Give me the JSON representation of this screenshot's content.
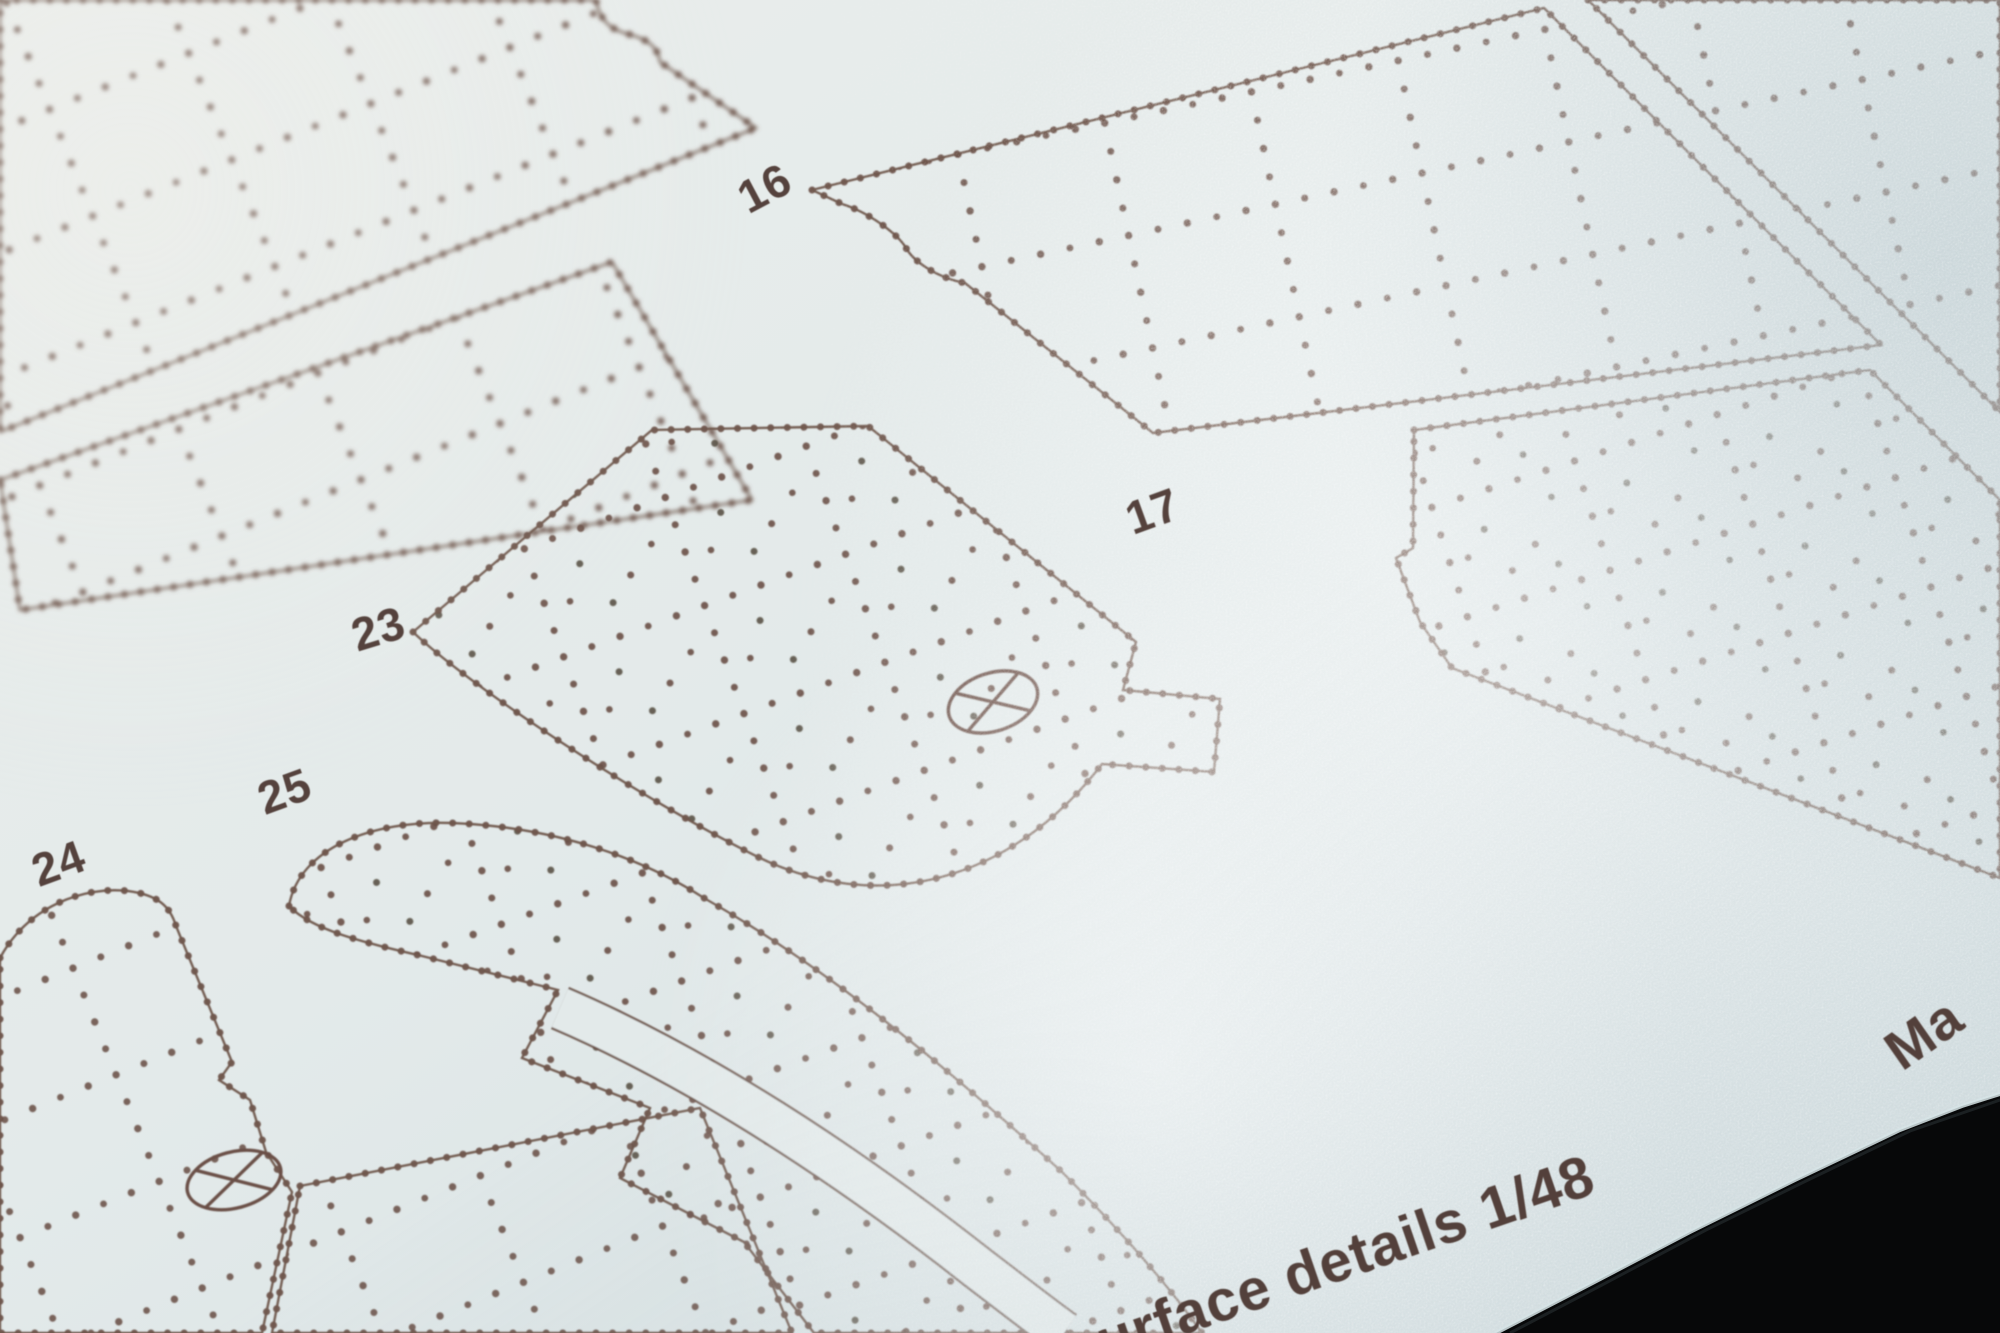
{
  "sheet": {
    "kind": "riveting-template-sheet-macro-photo",
    "scale_text_visible": "1/48"
  },
  "part_labels": [
    "16",
    "17",
    "23",
    "24",
    "25"
  ],
  "captions": {
    "bottom": "urface details 1/48",
    "right_edge": "Ma"
  },
  "icons": {
    "crossed_circle": "crossed-circle-marker"
  },
  "colors": {
    "sheet_base": "#e9edec",
    "sheet_shade": "#d2dde0",
    "print_ink": "#6a5046",
    "label_ink": "#55433d",
    "backdrop": "#070809",
    "edge_highlight": "#d6e4e6"
  }
}
